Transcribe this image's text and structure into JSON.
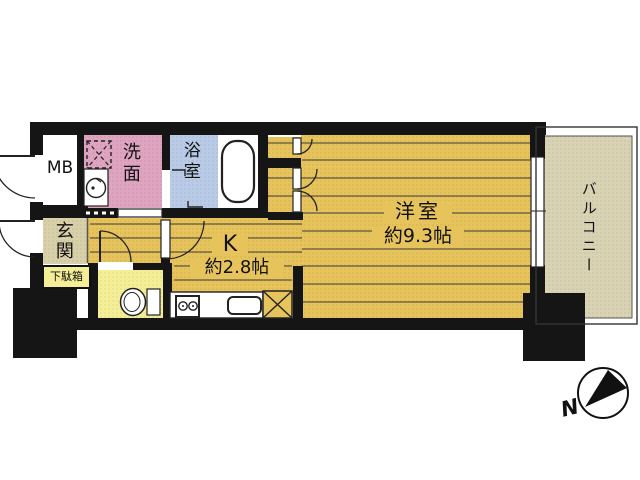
{
  "floorplan": {
    "title": "apartment-floorplan",
    "rooms": {
      "meter_box": {
        "label": "MB"
      },
      "washroom": {
        "label": "洗面"
      },
      "bathroom": {
        "label": "浴室"
      },
      "entrance": {
        "label": "玄関"
      },
      "shoe_cabinet": {
        "label": "下駄箱"
      },
      "kitchen": {
        "label": "K",
        "size": "約2.8帖"
      },
      "western_room": {
        "label": "洋室",
        "size": "約9.3帖"
      },
      "balcony": {
        "label": "バルコニー"
      }
    },
    "compass": {
      "north_label": "N"
    },
    "colors": {
      "wall": "#151515",
      "room_yellow": "#e7c35c",
      "bright_yellow": "#f4ee96",
      "pink": "#dfa4c0",
      "blue": "#b9cbe6",
      "beige": "#d7d0a8",
      "balcony_beige": "#d9d3b4",
      "white": "#ffffff"
    }
  }
}
